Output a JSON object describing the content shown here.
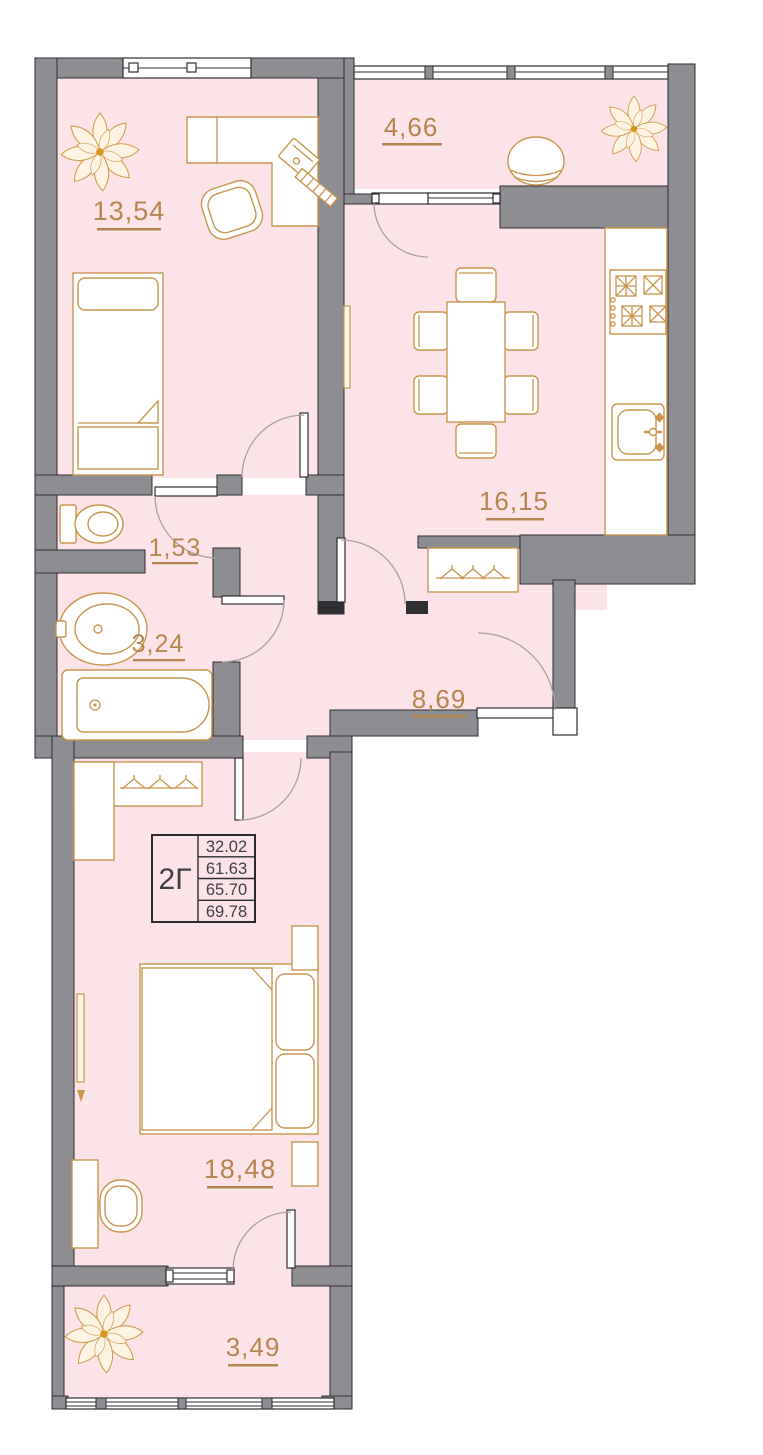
{
  "floor_plan": {
    "unit": {
      "type_label": "2Г",
      "areas": [
        "32.02",
        "61.63",
        "65.70",
        "69.78"
      ]
    },
    "rooms": [
      {
        "name": "bedroom-top",
        "area": "13,54"
      },
      {
        "name": "balcony-top",
        "area": "4,66"
      },
      {
        "name": "kitchen",
        "area": "16,15"
      },
      {
        "name": "wc",
        "area": "1,53"
      },
      {
        "name": "bathroom",
        "area": "3,24"
      },
      {
        "name": "hallway",
        "area": "8,69"
      },
      {
        "name": "bedroom-bottom",
        "area": "18,48"
      },
      {
        "name": "balcony-bottom",
        "area": "3,49"
      }
    ],
    "colors": {
      "room_fill": "#fbe3e7",
      "wall_fill": "#8d8d92",
      "wall_line": "#2e2e33",
      "furniture": "#c9954f",
      "label": "#b5854f",
      "table_border": "#2b2b2e",
      "table_text": "#3f3f44"
    }
  }
}
